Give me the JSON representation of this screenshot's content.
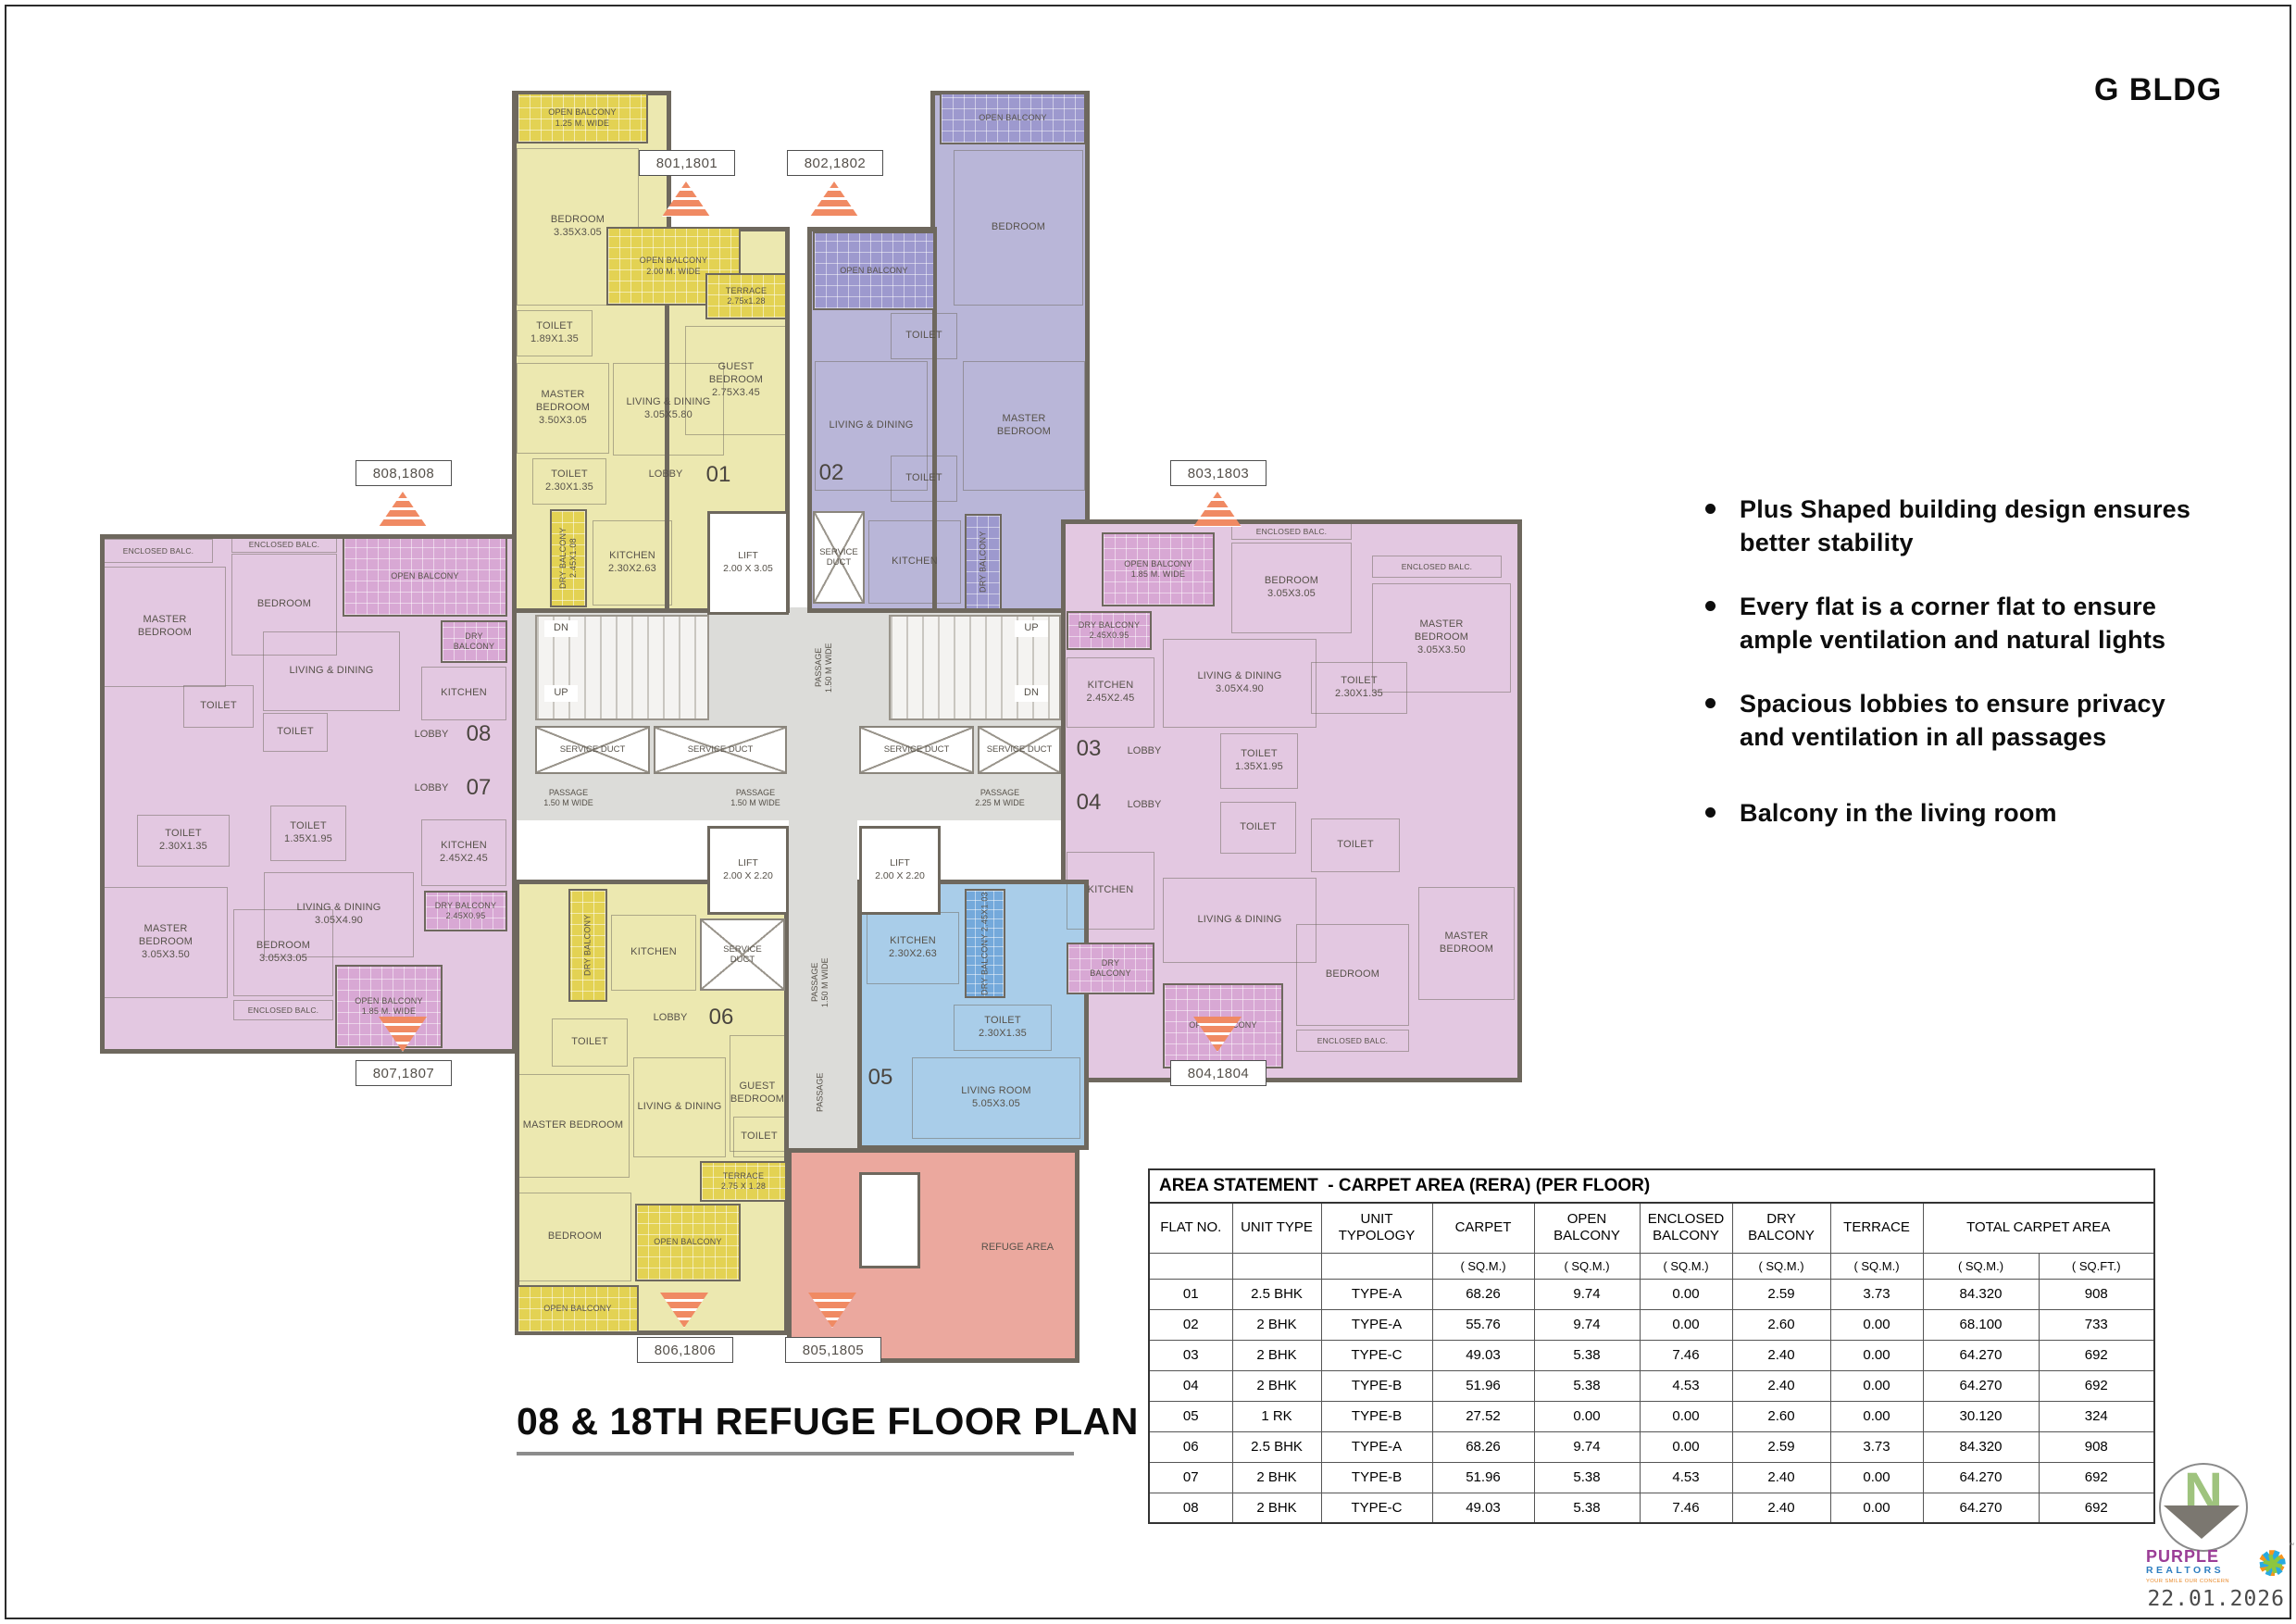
{
  "page": {
    "building": "G BLDG",
    "title": "08 & 18TH REFUGE FLOOR PLAN",
    "date": "22.01.2026"
  },
  "features": [
    "Plus Shaped building design ensures better stability",
    "Every flat is a corner flat to ensure ample ventilation and natural lights",
    "Spacious lobbies to ensure privacy and ventilation in all passages",
    "Balcony in the living room"
  ],
  "labels": {
    "b801": "801,1801",
    "b802": "802,1802",
    "b803": "803,1803",
    "b804": "804,1804",
    "b805": "805,1805",
    "b806": "806,1806",
    "b807": "807,1807",
    "b808": "808,1808"
  },
  "plan": {
    "refuge": "REFUGE AREA",
    "nums": {
      "n01": "01",
      "n02": "02",
      "n03": "03",
      "n04": "04",
      "n05": "05",
      "n06": "06",
      "n07": "07",
      "n08": "08"
    },
    "core": {
      "lift_big": "LIFT\n2.00 X 3.05",
      "lift_small": "LIFT\n2.00 X 2.20",
      "duct": "SERVICE DUCT",
      "duct2": "SERVICE\nDUCT",
      "passage_150": "PASSAGE\n1.50 M WIDE",
      "passage_225": "PASSAGE\n2.25 M WIDE",
      "passage": "PASSAGE",
      "up": "UP",
      "dn": "DN"
    },
    "u01": [
      "OPEN BALCONY\n1.25 M. WIDE",
      "BEDROOM\n3.35X3.05",
      "OPEN BALCONY\n2.00 M. WIDE",
      "TOILET\n1.89X1.35",
      "MASTER\nBEDROOM\n3.50X3.05",
      "LIVING & DINING\n3.05X5.80",
      "TERRACE\n2.75x1.28",
      "GUEST\nBEDROOM\n2.75X3.45",
      "TOILET\n2.30X1.35",
      "LOBBY",
      "DRY BALCONY 2.45X1.08",
      "KITCHEN\n2.30X2.63"
    ],
    "u02": [
      "OPEN BALCONY",
      "BEDROOM",
      "OPEN BALCONY",
      "TOILET",
      "LIVING & DINING",
      "MASTER\nBEDROOM",
      "TOILET",
      "KITCHEN",
      "DRY BALCONY",
      "SERVICE\nDUCT"
    ],
    "u03": [
      "OPEN BALCONY\n1.85 M. WIDE",
      "DRY BALCONY\n2.45X0.95",
      "KITCHEN\n2.45X2.45",
      "LIVING & DINING\n3.05X4.90",
      "BEDROOM\n3.05X3.05",
      "ENCLOSED BALC.",
      "ENCLOSED BALC.",
      "MASTER\nBEDROOM\n3.05X3.50",
      "TOILET\n2.30X1.35",
      "TOILET\n1.35X1.95",
      "LOBBY"
    ],
    "u04": [
      "LOBBY",
      "KITCHEN",
      "LIVING & DINING",
      "TOILET",
      "TOILET",
      "DRY\nBALCONY",
      "OPEN BALCONY",
      "BEDROOM",
      "MASTER\nBEDROOM",
      "ENCLOSED BALC."
    ],
    "u05": [
      "KITCHEN\n2.30X2.63",
      "DRY BALCONY 2.45X1.03",
      "TOILET\n2.30X1.35",
      "LIVING ROOM\n5.05X3.05"
    ],
    "u06": [
      "DRY BALCONY",
      "KITCHEN",
      "LOBBY",
      "TOILET",
      "MASTER BEDROOM",
      "LIVING & DINING",
      "GUEST\nBEDROOM",
      "TOILET",
      "BEDROOM",
      "OPEN BALCONY",
      "TERRACE\n2.75 X 1.28",
      "OPEN BALCONY"
    ],
    "u07": [
      "LOBBY",
      "TOILET\n2.30X1.35",
      "TOILET\n1.35X1.95",
      "LIVING & DINING\n3.05X4.90",
      "KITCHEN\n2.45X2.45",
      "MASTER\nBEDROOM\n3.05X3.50",
      "BEDROOM\n3.05X3.05",
      "ENCLOSED BALC.",
      "OPEN BALCONY\n1.85 M. WIDE",
      "DRY BALCONY\n2.45X0.95"
    ],
    "u08": [
      "ENCLOSED BALC.",
      "MASTER\nBEDROOM",
      "BEDROOM",
      "ENCLOSED BALC.",
      "OPEN BALCONY",
      "DRY\nBALCONY",
      "LIVING & DINING",
      "KITCHEN",
      "TOILET",
      "TOILET",
      "LOBBY"
    ]
  },
  "table": {
    "title": "AREA STATEMENT  - CARPET AREA (RERA) (PER FLOOR)",
    "headers": [
      "FLAT NO.",
      "UNIT TYPE",
      "UNIT TYPOLOGY",
      "CARPET",
      "OPEN BALCONY",
      "ENCLOSED BALCONY",
      "DRY BALCONY",
      "TERRACE",
      "TOTAL CARPET AREA"
    ],
    "sub": [
      "",
      "",
      "",
      "( SQ.M.)",
      "( SQ.M.)",
      "( SQ.M.)",
      "( SQ.M.)",
      "( SQ.M.)",
      "( SQ.M.)",
      "( SQ.FT.)"
    ],
    "rows": [
      [
        "01",
        "2.5 BHK",
        "TYPE-A",
        "68.26",
        "9.74",
        "0.00",
        "2.59",
        "3.73",
        "84.320",
        "908"
      ],
      [
        "02",
        "2 BHK",
        "TYPE-A",
        "55.76",
        "9.74",
        "0.00",
        "2.60",
        "0.00",
        "68.100",
        "733"
      ],
      [
        "03",
        "2 BHK",
        "TYPE-C",
        "49.03",
        "5.38",
        "7.46",
        "2.40",
        "0.00",
        "64.270",
        "692"
      ],
      [
        "04",
        "2 BHK",
        "TYPE-B",
        "51.96",
        "5.38",
        "4.53",
        "2.40",
        "0.00",
        "64.270",
        "692"
      ],
      [
        "05",
        "1 RK",
        "TYPE-B",
        "27.52",
        "0.00",
        "0.00",
        "2.60",
        "0.00",
        "30.120",
        "324"
      ],
      [
        "06",
        "2.5 BHK",
        "TYPE-A",
        "68.26",
        "9.74",
        "0.00",
        "2.59",
        "3.73",
        "84.320",
        "908"
      ],
      [
        "07",
        "2 BHK",
        "TYPE-B",
        "51.96",
        "5.38",
        "4.53",
        "2.40",
        "0.00",
        "64.270",
        "692"
      ],
      [
        "08",
        "2 BHK",
        "TYPE-C",
        "49.03",
        "5.38",
        "7.46",
        "2.40",
        "0.00",
        "64.270",
        "692"
      ]
    ]
  },
  "footer": {
    "north": "N",
    "brand_line1": "PURPLE",
    "brand_line2": "REALTORS",
    "brand_tagline": "YOUR SMILE OUR CONCERN",
    "tm": "™",
    "date": "22.01.2026"
  },
  "colors": {
    "wall": "#6E685E",
    "yellow": "#ECE8B0",
    "yellow_hatch": "#E3D253",
    "purple": "#B9B6D8",
    "purple_hatch": "#9D99CE",
    "pink": "#E3C8E1",
    "pink_hatch": "#D8A8D4",
    "blue": "#A9CDE9",
    "blue_hatch": "#74A9DB",
    "refuge_salmon": "#EBA89E",
    "passage_gray": "#DCDCD9",
    "marker_orange": "#F08A63"
  }
}
